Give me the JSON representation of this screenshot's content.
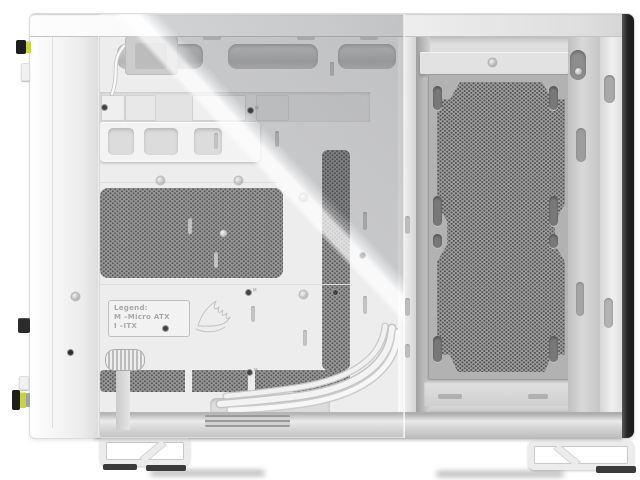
{
  "scene": {
    "description": "Side view of a white dual-chamber PC case: tempered glass over the main motherboard chamber on the left, open perforated fan-mount chamber on the right, dark rear edge, two white bracket feet",
    "background_color": "#ffffff"
  },
  "legend": {
    "title": "Legend:",
    "row1": "M –Micro ATX",
    "row2": "I –ITX"
  },
  "logo": {
    "name": "corsair-sails-logo"
  },
  "colors": {
    "body_white": "#f0f0f0",
    "recess_gray": "#c9c9c9",
    "mesh_base": "#8d8d8d",
    "mesh_hole": "#474747",
    "rear_edge_dark": "#262626",
    "accent_yellow": "#c9d23f",
    "glass_tint": "rgba(95,98,105,0.28)"
  },
  "markers": {
    "screws": [
      [
        160,
        180
      ],
      [
        238,
        180
      ],
      [
        303,
        197
      ],
      [
        223,
        233
      ],
      [
        492,
        62
      ],
      [
        578,
        71
      ],
      [
        75,
        296
      ],
      [
        303,
        294
      ]
    ],
    "standoffs": [
      {
        "x": 250,
        "y": 110,
        "label": "M"
      },
      {
        "x": 104,
        "y": 107,
        "label": ""
      },
      {
        "x": 165,
        "y": 328,
        "label": ""
      },
      {
        "x": 248,
        "y": 292,
        "label": "M"
      },
      {
        "x": 335,
        "y": 292,
        "label": "M"
      },
      {
        "x": 249,
        "y": 372,
        "label": "M"
      },
      {
        "x": 70,
        "y": 352,
        "label": ""
      },
      {
        "x": 362,
        "y": 255,
        "label": ""
      }
    ],
    "tie_slots": [
      [
        214,
        133,
        16
      ],
      [
        275,
        131,
        16
      ],
      [
        188,
        218,
        16
      ],
      [
        214,
        252,
        16
      ],
      [
        251,
        306,
        16
      ],
      [
        303,
        330,
        16
      ],
      [
        363,
        212,
        18
      ],
      [
        363,
        296,
        18
      ],
      [
        330,
        62,
        14
      ]
    ],
    "plate_slots": {
      "cols": [
        433,
        549
      ],
      "rows": [
        {
          "y": 86,
          "h": 24
        },
        {
          "y": 196,
          "h": 30
        },
        {
          "y": 234,
          "h": 14
        },
        {
          "y": 336,
          "h": 26
        }
      ]
    }
  }
}
